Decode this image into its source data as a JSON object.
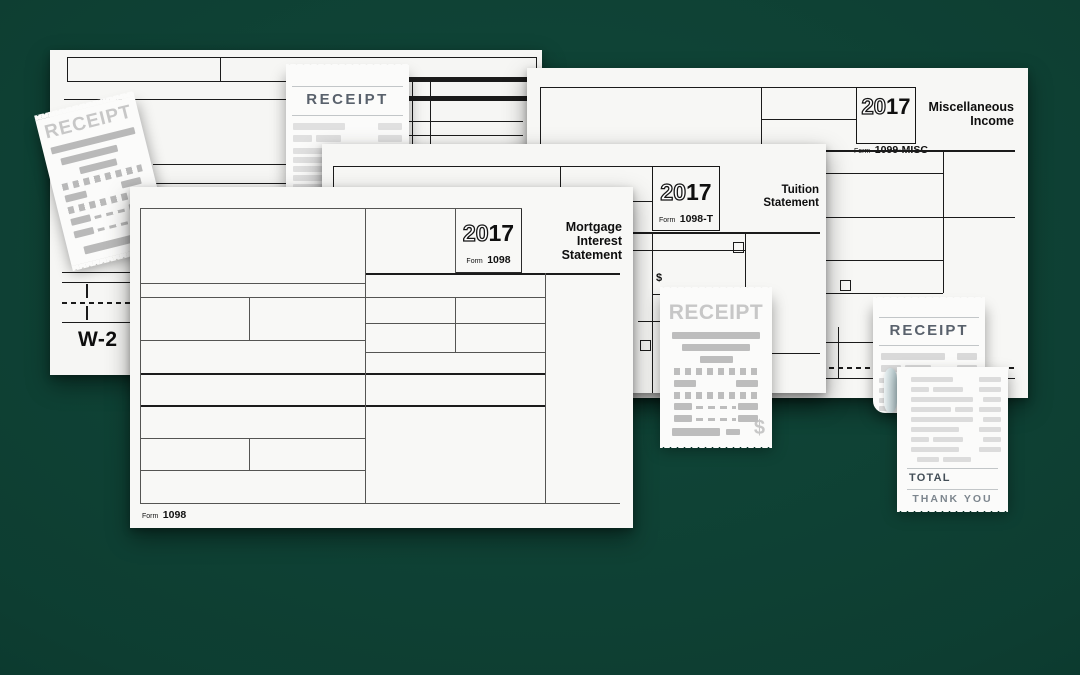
{
  "background": {
    "color": "#0d3d31"
  },
  "w2": {
    "label": "W-2"
  },
  "f1098": {
    "year_left": "20",
    "year_right": "17",
    "form_label": "Form",
    "form_number": "1098",
    "title1": "Mortgage",
    "title2": "Interest",
    "title3": "Statement",
    "foot_form_label": "Form",
    "foot_form_number": "1098"
  },
  "f1098t": {
    "year_left": "20",
    "year_right": "17",
    "form_label": "Form",
    "form_number": "1098-T",
    "title1": "Tuition",
    "title2": "Statement",
    "dollar": "$"
  },
  "f1099": {
    "year_left": "20",
    "year_right": "17",
    "form_label": "Form",
    "form_number": "1099-MISC",
    "title1": "Miscellaneous",
    "title2": "Income"
  },
  "receipts": {
    "tilted_title": "RECEIPT",
    "top_title": "RECEIPT",
    "middle_title": "RECEIPT",
    "middle_dollar": "$",
    "back_title": "RECEIPT",
    "total_label": "TOTAL",
    "thankyou_label": "THANK YOU"
  }
}
